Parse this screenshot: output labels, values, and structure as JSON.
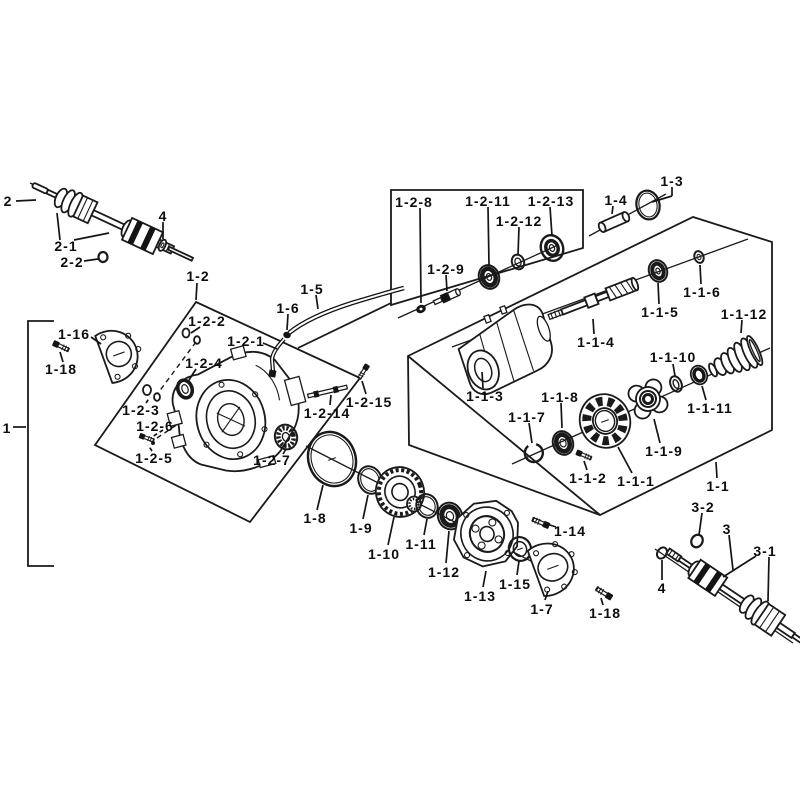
{
  "diagram": {
    "type": "exploded-parts-diagram",
    "subject": "front differential and drive axle assembly",
    "background_color": "#ffffff",
    "line_color": "#1a1a1a",
    "labels": [
      {
        "part_no": "2",
        "x": 8,
        "y": 201,
        "leaders": [
          [
            16,
            201,
            36,
            200,
            0
          ]
        ]
      },
      {
        "part_no": "2-1",
        "x": 66,
        "y": 246,
        "leaders": [
          [
            60,
            240,
            57,
            213,
            0
          ],
          [
            74,
            240,
            109,
            233,
            0
          ]
        ]
      },
      {
        "part_no": "2-2",
        "x": 72,
        "y": 262,
        "leaders": [
          [
            84,
            261,
            98,
            259,
            0
          ]
        ]
      },
      {
        "part_no": "4",
        "x": 163,
        "y": 216,
        "leaders": [
          [
            163,
            222,
            163,
            239,
            0
          ]
        ]
      },
      {
        "part_no": "1-2",
        "x": 198,
        "y": 276,
        "leaders": [
          [
            197,
            283,
            196,
            300,
            0
          ]
        ]
      },
      {
        "part_no": "1-16",
        "x": 74,
        "y": 334,
        "leaders": [
          [
            91,
            337,
            101,
            344,
            0
          ]
        ]
      },
      {
        "part_no": "1-18",
        "x": 61,
        "y": 369,
        "leaders": [
          [
            63,
            362,
            60,
            352,
            0
          ]
        ]
      },
      {
        "part_no": "1",
        "x": 7,
        "y": 428,
        "leaders": [
          [
            13,
            427,
            26,
            427,
            0
          ]
        ]
      },
      {
        "part_no": "1-2-2",
        "x": 207,
        "y": 321,
        "leaders": [
          [
            200,
            327,
            191,
            333,
            0
          ]
        ]
      },
      {
        "part_no": "1-2-1",
        "x": 246,
        "y": 341,
        "leaders": [
          [
            263,
            343,
            277,
            349,
            0
          ]
        ]
      },
      {
        "part_no": "1-2-4",
        "x": 204,
        "y": 363,
        "leaders": [
          [
            196,
            369,
            189,
            380,
            0
          ]
        ]
      },
      {
        "part_no": "1-2-3",
        "x": 141,
        "y": 410,
        "leaders": [
          [
            146,
            403,
            150,
            397,
            1
          ]
        ]
      },
      {
        "part_no": "1-2-6",
        "x": 155,
        "y": 426,
        "leaders": [
          [
            163,
            430,
            152,
            437,
            1
          ]
        ]
      },
      {
        "part_no": "1-2-5",
        "x": 154,
        "y": 458,
        "leaders": [
          [
            152,
            451,
            148,
            445,
            1
          ]
        ]
      },
      {
        "part_no": "1-2-7",
        "x": 272,
        "y": 460,
        "leaders": [
          [
            283,
            454,
            286,
            449,
            0
          ]
        ]
      },
      {
        "part_no": "1-5",
        "x": 312,
        "y": 289,
        "leaders": [
          [
            316,
            295,
            318,
            309,
            0
          ]
        ]
      },
      {
        "part_no": "1-6",
        "x": 288,
        "y": 308,
        "leaders": [
          [
            288,
            314,
            287,
            330,
            0
          ]
        ]
      },
      {
        "part_no": "1-2-14",
        "x": 327,
        "y": 413,
        "leaders": [
          [
            330,
            405,
            331,
            395,
            0
          ]
        ]
      },
      {
        "part_no": "1-2-15",
        "x": 369,
        "y": 402,
        "leaders": [
          [
            366,
            394,
            362,
            381,
            0
          ]
        ]
      },
      {
        "part_no": "1-2-8",
        "x": 414,
        "y": 202,
        "leaders": [
          [
            420,
            208,
            421,
            303,
            0
          ]
        ]
      },
      {
        "part_no": "1-2-9",
        "x": 446,
        "y": 269,
        "leaders": [
          [
            446,
            275,
            447,
            291,
            0
          ]
        ]
      },
      {
        "part_no": "1-2-11",
        "x": 488,
        "y": 201,
        "leaders": [
          [
            488,
            207,
            489,
            265,
            0
          ]
        ]
      },
      {
        "part_no": "1-2-12",
        "x": 519,
        "y": 221,
        "leaders": [
          [
            519,
            227,
            518,
            255,
            0
          ]
        ]
      },
      {
        "part_no": "1-2-13",
        "x": 551,
        "y": 201,
        "leaders": [
          [
            550,
            207,
            552,
            236,
            0
          ]
        ]
      },
      {
        "part_no": "1-4",
        "x": 616,
        "y": 200,
        "leaders": [
          [
            613,
            206,
            612,
            214,
            0
          ]
        ]
      },
      {
        "part_no": "1-3",
        "x": 672,
        "y": 181,
        "leaders": [
          [
            672,
            187,
            672,
            196,
            0
          ],
          [
            672,
            196,
            652,
            202,
            0
          ]
        ]
      },
      {
        "part_no": "1-1-5",
        "x": 660,
        "y": 312,
        "leaders": [
          [
            659,
            304,
            658,
            283,
            0
          ]
        ]
      },
      {
        "part_no": "1-1-6",
        "x": 702,
        "y": 292,
        "leaders": [
          [
            701,
            284,
            700,
            265,
            0
          ]
        ]
      },
      {
        "part_no": "1-1-12",
        "x": 744,
        "y": 314,
        "leaders": [
          [
            742,
            320,
            741,
            333,
            0
          ]
        ]
      },
      {
        "part_no": "1-1-4",
        "x": 596,
        "y": 342,
        "leaders": [
          [
            594,
            334,
            593,
            319,
            0
          ]
        ]
      },
      {
        "part_no": "1-1-3",
        "x": 485,
        "y": 396,
        "leaders": [
          [
            483,
            388,
            482,
            372,
            0
          ]
        ]
      },
      {
        "part_no": "1-1-10",
        "x": 673,
        "y": 357,
        "leaders": [
          [
            673,
            364,
            675,
            376,
            0
          ]
        ]
      },
      {
        "part_no": "1-1-11",
        "x": 710,
        "y": 408,
        "leaders": [
          [
            706,
            400,
            702,
            386,
            0
          ]
        ]
      },
      {
        "part_no": "1-1-8",
        "x": 560,
        "y": 397,
        "leaders": [
          [
            561,
            403,
            562,
            428,
            0
          ]
        ]
      },
      {
        "part_no": "1-1-7",
        "x": 527,
        "y": 417,
        "leaders": [
          [
            529,
            423,
            532,
            443,
            0
          ]
        ]
      },
      {
        "part_no": "1-1-9",
        "x": 664,
        "y": 451,
        "leaders": [
          [
            660,
            443,
            654,
            419,
            0
          ]
        ]
      },
      {
        "part_no": "1-1-2",
        "x": 588,
        "y": 478,
        "leaders": [
          [
            587,
            470,
            584,
            461,
            0
          ]
        ]
      },
      {
        "part_no": "1-1-1",
        "x": 636,
        "y": 481,
        "leaders": [
          [
            632,
            473,
            618,
            447,
            0
          ]
        ]
      },
      {
        "part_no": "1-1",
        "x": 718,
        "y": 486,
        "leaders": [
          [
            717,
            478,
            716,
            462,
            0
          ]
        ]
      },
      {
        "part_no": "1-8",
        "x": 315,
        "y": 518,
        "leaders": [
          [
            317,
            510,
            323,
            485,
            0
          ]
        ]
      },
      {
        "part_no": "1-9",
        "x": 361,
        "y": 528,
        "leaders": [
          [
            363,
            519,
            368,
            495,
            0
          ]
        ]
      },
      {
        "part_no": "1-10",
        "x": 384,
        "y": 554,
        "leaders": [
          [
            388,
            545,
            394,
            517,
            0
          ]
        ]
      },
      {
        "part_no": "1-11",
        "x": 421,
        "y": 544,
        "leaders": [
          [
            424,
            535,
            427,
            519,
            0
          ]
        ]
      },
      {
        "part_no": "1-12",
        "x": 444,
        "y": 572,
        "leaders": [
          [
            446,
            563,
            449,
            531,
            0
          ]
        ]
      },
      {
        "part_no": "1-13",
        "x": 480,
        "y": 596,
        "leaders": [
          [
            483,
            587,
            486,
            571,
            0
          ]
        ]
      },
      {
        "part_no": "1-15",
        "x": 515,
        "y": 584,
        "leaders": [
          [
            517,
            575,
            519,
            561,
            0
          ]
        ]
      },
      {
        "part_no": "1-7",
        "x": 542,
        "y": 609,
        "leaders": [
          [
            545,
            600,
            548,
            591,
            0
          ]
        ]
      },
      {
        "part_no": "1-14",
        "x": 570,
        "y": 531,
        "leaders": [
          [
            556,
            527,
            547,
            524,
            0
          ]
        ]
      },
      {
        "part_no": "1-18",
        "x": 605,
        "y": 613,
        "leaders": [
          [
            603,
            605,
            601,
            598,
            0
          ]
        ]
      },
      {
        "part_no": "3-2",
        "x": 703,
        "y": 507,
        "leaders": [
          [
            702,
            513,
            699,
            535,
            0
          ]
        ]
      },
      {
        "part_no": "3",
        "x": 727,
        "y": 529,
        "leaders": [
          [
            729,
            535,
            733,
            570,
            0
          ]
        ]
      },
      {
        "part_no": "3-1",
        "x": 765,
        "y": 551,
        "leaders": [
          [
            756,
            556,
            723,
            577,
            0
          ],
          [
            769,
            557,
            768,
            601,
            0
          ]
        ]
      },
      {
        "part_no": "4",
        "x": 662,
        "y": 588,
        "leaders": [
          [
            662,
            580,
            662,
            560,
            0
          ]
        ]
      }
    ]
  }
}
